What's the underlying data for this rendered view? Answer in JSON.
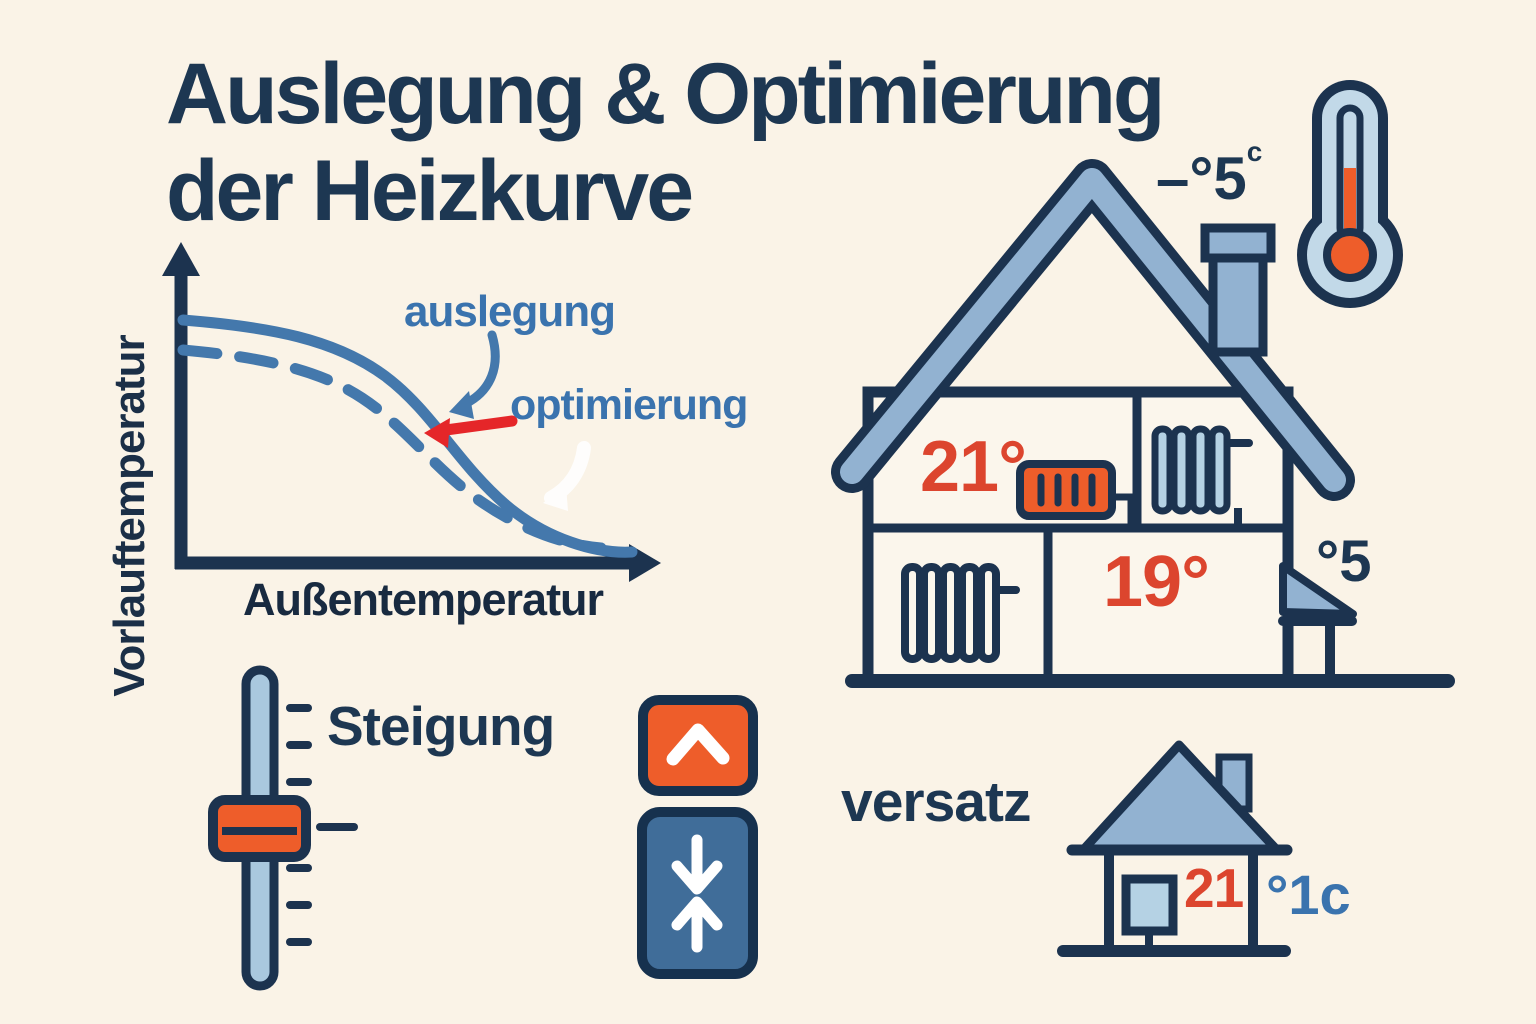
{
  "background_color": "#faf3e7",
  "colors": {
    "navy_text": "#1d3752",
    "outline_navy": "#1c334f",
    "curve_blue": "#4478ac",
    "label_blue": "#3a73ae",
    "arrow_red": "#e52629",
    "temp_red": "#dc452e",
    "orange": "#ee5d2a",
    "steel_blue": "#92b2d1",
    "light_blue": "#b5d2e4",
    "button_blue": "#406d99"
  },
  "title": {
    "line1": "Auslegung & Optimierung",
    "line2": "der Heizkurve"
  },
  "heating_curve_chart": {
    "y_axis_label": "Vorlauftemperatur",
    "x_axis_label": "Außentemperatur",
    "curve1_label": "auslegung",
    "curve2_label": "optimierung"
  },
  "chart_data": {
    "type": "line",
    "title": "",
    "xlabel": "Außentemperatur",
    "ylabel": "Vorlauftemperatur",
    "axis_numeric_ticks": false,
    "units": "relative (no numeric scale shown)",
    "x_relative": [
      0,
      0.15,
      0.3,
      0.45,
      0.6,
      0.75,
      0.9,
      1.0
    ],
    "series": [
      {
        "name": "auslegung",
        "style": "solid",
        "y_relative": [
          0.95,
          0.93,
          0.86,
          0.72,
          0.52,
          0.3,
          0.14,
          0.08
        ]
      },
      {
        "name": "optimierung",
        "style": "dashed",
        "y_relative": [
          0.83,
          0.81,
          0.74,
          0.62,
          0.44,
          0.26,
          0.12,
          0.07
        ]
      }
    ],
    "annotations": [
      "blue curved arrow pointing to auslegung curve",
      "red arrow pointing to optimierung curve"
    ],
    "legend_position": "inline labels upper right",
    "grid": false
  },
  "house": {
    "upstairs_temp": "21°",
    "downstairs_temp": "19°",
    "outside_temp": "–°5",
    "outside_temp_superscript": "c",
    "porch_outside_temp": "°5"
  },
  "steigung": {
    "label": "Steigung"
  },
  "versatz": {
    "label": "versatz",
    "indoor_temp": "21",
    "offset_value": "°1c"
  }
}
